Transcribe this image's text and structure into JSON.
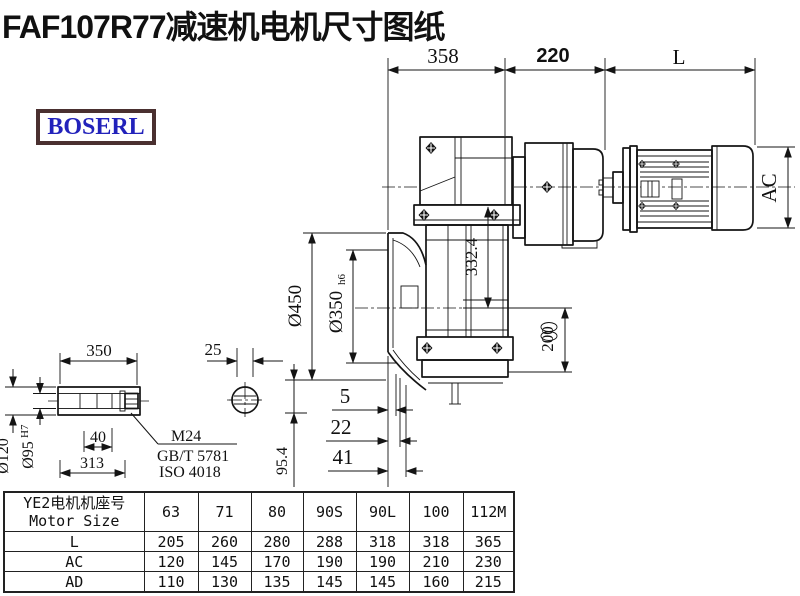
{
  "title": "FAF107R77减速机电机尺寸图纸",
  "logo": {
    "text": "BOSERL"
  },
  "drawing": {
    "top_dims": {
      "front_width": "358",
      "adapter_width": "220",
      "motor_length": "L"
    },
    "vertical_dims": {
      "flange_od": "Ø450",
      "spigot_d": "Ø350",
      "spigot_tol": "h6",
      "axis_height": "332.4",
      "foot_height": "200",
      "motor_height": "AC",
      "offset": "95.4"
    },
    "bottom_dims": {
      "d1": "5",
      "d2": "22",
      "d3": "41"
    },
    "shaft_detail": {
      "length": "350",
      "key_width": "25",
      "end_depth": "40",
      "usable_length": "313",
      "outer_d": "Ø120",
      "bore_d": "Ø95",
      "bore_tol": "H7",
      "screw": "M24",
      "standard1": "GB/T 5781",
      "standard2": "ISO 4018"
    }
  },
  "table": {
    "header_cn": "YE2电机机座号",
    "header_en": "Motor Size",
    "columns": [
      "63",
      "71",
      "80",
      "90S",
      "90L",
      "100",
      "112M"
    ],
    "rows": [
      {
        "label": "L",
        "values": [
          "205",
          "260",
          "280",
          "288",
          "318",
          "318",
          "365"
        ]
      },
      {
        "label": "AC",
        "values": [
          "120",
          "145",
          "170",
          "190",
          "190",
          "210",
          "230"
        ]
      },
      {
        "label": "AD",
        "values": [
          "110",
          "130",
          "135",
          "145",
          "145",
          "160",
          "215"
        ]
      }
    ]
  }
}
